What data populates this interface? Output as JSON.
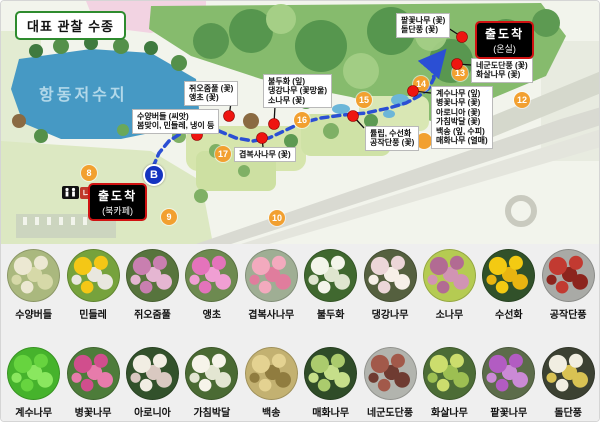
{
  "title": "대표 관찰 수종",
  "colors": {
    "route_blue": "#2b4fd4",
    "marker_orange": "#f2a030",
    "dot_red": "#ee1510",
    "terminus_border_red": "#d01212",
    "title_border_green": "#2e8b2e",
    "lake_blue": "#4699c4",
    "grid_bg": "#efefef"
  },
  "map": {
    "lake_label": "항동저수지",
    "terminus_top": {
      "line1": "출도착",
      "line2": "(온실)",
      "x": 474,
      "y": 20
    },
    "terminus_bottom": {
      "line1": "출도착",
      "line2": "(북카페)",
      "x": 87,
      "y": 182
    },
    "b_marker": "B",
    "na_marker": "나",
    "numbered_markers": [
      {
        "n": "8",
        "x": 88,
        "y": 172
      },
      {
        "n": "9",
        "x": 168,
        "y": 216
      },
      {
        "n": "10",
        "x": 276,
        "y": 217
      },
      {
        "n": "",
        "x": 423,
        "y": 140
      },
      {
        "n": "12",
        "x": 521,
        "y": 99
      },
      {
        "n": "13",
        "x": 459,
        "y": 72
      },
      {
        "n": "14",
        "x": 420,
        "y": 83
      },
      {
        "n": "15",
        "x": 363,
        "y": 99
      },
      {
        "n": "16",
        "x": 301,
        "y": 119
      },
      {
        "n": "17",
        "x": 222,
        "y": 153
      }
    ],
    "annotations": [
      {
        "lines": [
          "쥐오줌풀 (꽃)",
          "앵초 (꽃)"
        ],
        "box": {
          "x": 183,
          "y": 80
        },
        "dot": {
          "x": 228,
          "y": 115
        },
        "leader": {
          "x": 230,
          "y": 102
        }
      },
      {
        "lines": [
          "불두화 (잎)",
          "댕강나무 (꽃망울)",
          "소나무 (꽃)"
        ],
        "box": {
          "x": 262,
          "y": 73
        },
        "dot": {
          "x": 273,
          "y": 123
        },
        "leader": {
          "x": 274,
          "y": 105
        }
      },
      {
        "lines": [
          "수양버들 (씨앗)",
          "봄맞이, 민들레, 냉이 등"
        ],
        "box": {
          "x": 131,
          "y": 108
        },
        "dot": {
          "x": 196,
          "y": 134
        },
        "leader": {
          "x": 188,
          "y": 128
        }
      },
      {
        "lines": [
          "겹복사나무 (꽃)"
        ],
        "box": {
          "x": 233,
          "y": 146
        },
        "dot": {
          "x": 261,
          "y": 137
        },
        "leader": {
          "x": 262,
          "y": 146
        }
      },
      {
        "lines": [
          "튤립, 수선화",
          "공작단풍 (꽃)"
        ],
        "box": {
          "x": 364,
          "y": 125
        },
        "dot": {
          "x": 352,
          "y": 115
        },
        "leader": {
          "x": 363,
          "y": 127
        }
      },
      {
        "lines": [
          "계수나무 (잎)",
          "병꽃나무 (꽃)",
          "아로니아 (꽃)",
          "가침박달 (꽃)",
          "백송 (잎, 수피)",
          "매화나무 (열매)"
        ],
        "box": {
          "x": 430,
          "y": 85
        },
        "dot": {
          "x": 412,
          "y": 90
        },
        "leader": {
          "x": 430,
          "y": 92
        }
      },
      {
        "lines": [
          "네군도단풍 (꽃)",
          "화살나무 (꽃)"
        ],
        "box": {
          "x": 470,
          "y": 57
        },
        "dot": {
          "x": 456,
          "y": 63
        },
        "leader": {
          "x": 470,
          "y": 64
        }
      },
      {
        "lines": [
          "팥꽃나무 (꽃)",
          "돌단풍 (꽃)"
        ],
        "box": {
          "x": 395,
          "y": 12
        },
        "dot": {
          "x": 461,
          "y": 36
        },
        "leader": {
          "x": 444,
          "y": 25
        }
      }
    ]
  },
  "plants": {
    "row1": [
      {
        "name": "수양버들",
        "c": [
          "#aab87e",
          "#ece8d2",
          "#d6d9a8"
        ]
      },
      {
        "name": "민들레",
        "c": [
          "#76a23c",
          "#f4c716",
          "#e9e7df"
        ]
      },
      {
        "name": "쥐오줌풀",
        "c": [
          "#57743d",
          "#c97fb0",
          "#e5b6d2"
        ]
      },
      {
        "name": "앵초",
        "c": [
          "#6d8a50",
          "#e473bb",
          "#f09fd3"
        ]
      },
      {
        "name": "겹복사나무",
        "c": [
          "#9fae94",
          "#f3aabe",
          "#e07d9d"
        ]
      },
      {
        "name": "불두화",
        "c": [
          "#40682f",
          "#f3f5ea",
          "#dfe6cf"
        ]
      },
      {
        "name": "댕강나무",
        "c": [
          "#55603f",
          "#ecd6d8",
          "#f7f0e8"
        ]
      },
      {
        "name": "소나무",
        "c": [
          "#b5cb52",
          "#b26b93",
          "#d194b3"
        ]
      },
      {
        "name": "수선화",
        "c": [
          "#31512a",
          "#f3ca12",
          "#e8b511"
        ]
      },
      {
        "name": "공작단풍",
        "c": [
          "#a9aaa6",
          "#c23a31",
          "#8c241d"
        ]
      }
    ],
    "row2": [
      {
        "name": "계수나무",
        "c": [
          "#46b32c",
          "#67d43f",
          "#8ae75f"
        ]
      },
      {
        "name": "병꽃나무",
        "c": [
          "#4d7c3a",
          "#d14e8d",
          "#e77bab"
        ]
      },
      {
        "name": "아로니아",
        "c": [
          "#32512b",
          "#f1eee3",
          "#d9c9c1"
        ]
      },
      {
        "name": "가침박달",
        "c": [
          "#4a6a33",
          "#f6f4ea",
          "#e3e6d2"
        ]
      },
      {
        "name": "백송",
        "c": [
          "#c3b171",
          "#e4d291",
          "#907c3f"
        ]
      },
      {
        "name": "매화나무",
        "c": [
          "#2f4c28",
          "#abcb6d",
          "#c6df8a"
        ]
      },
      {
        "name": "네군도단풍",
        "c": [
          "#b2b4ae",
          "#a2594a",
          "#6f3b31"
        ]
      },
      {
        "name": "화살나무",
        "c": [
          "#4c6c36",
          "#ccdd6d",
          "#9dbf52"
        ]
      },
      {
        "name": "팥꽃나무",
        "c": [
          "#5c6c4a",
          "#b25cc2",
          "#cb8ad6"
        ]
      },
      {
        "name": "돌단풍",
        "c": [
          "#3c4132",
          "#f1eee1",
          "#d9c253"
        ]
      }
    ]
  }
}
